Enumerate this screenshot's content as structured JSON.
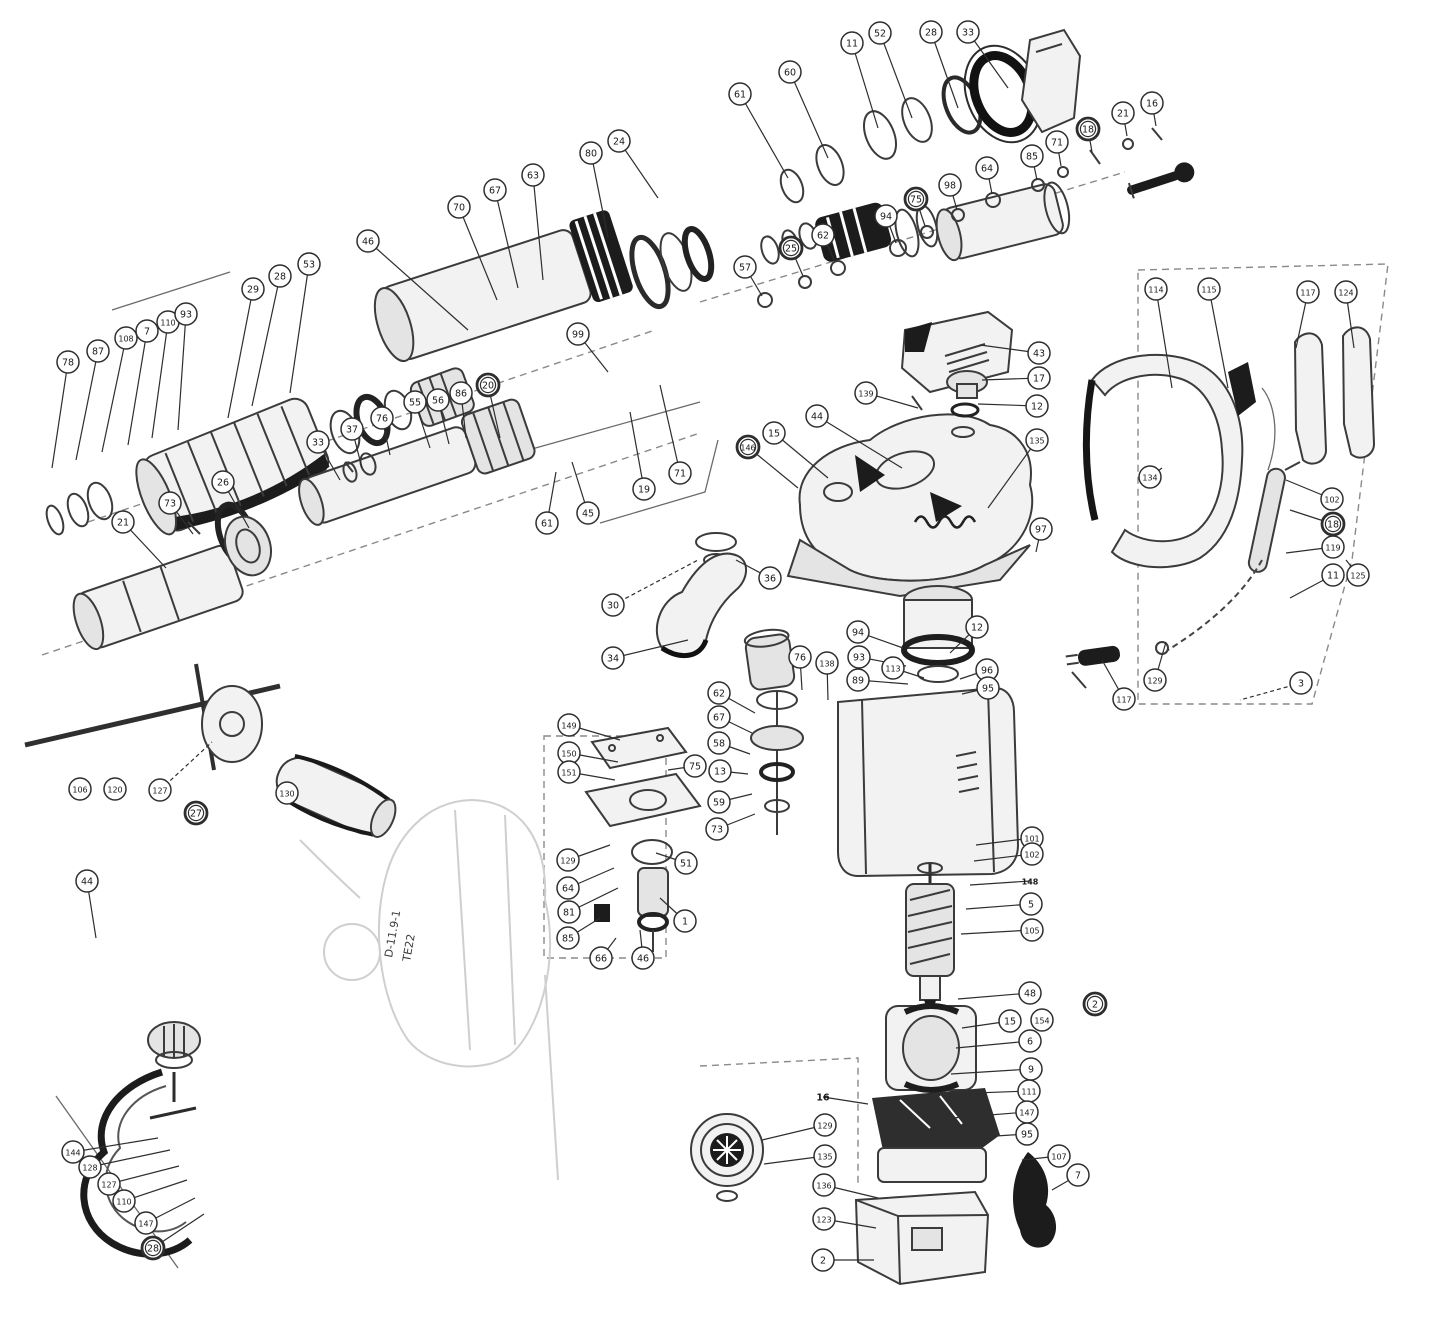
{
  "diagram": {
    "kind": "exploded-parts-diagram",
    "subject": "rotary-hammer-drill",
    "stamp": {
      "line1": "D-11.9-1",
      "line2": "TE22"
    },
    "style": {
      "ink": "#2e2e2e",
      "paper": "#ffffff",
      "callout_fill": "#ffffff"
    },
    "callouts": [
      {
        "n": "78",
        "x": 68,
        "y": 362,
        "tx": 52,
        "ty": 468
      },
      {
        "n": "87",
        "x": 98,
        "y": 351,
        "tx": 76,
        "ty": 460
      },
      {
        "n": "108",
        "x": 126,
        "y": 338,
        "tx": 102,
        "ty": 452
      },
      {
        "n": "7",
        "x": 147,
        "y": 331,
        "tx": 128,
        "ty": 445
      },
      {
        "n": "110",
        "x": 168,
        "y": 322,
        "tx": 152,
        "ty": 438
      },
      {
        "n": "93",
        "x": 186,
        "y": 314,
        "tx": 178,
        "ty": 430
      },
      {
        "n": "29",
        "x": 253,
        "y": 289,
        "tx": 228,
        "ty": 418
      },
      {
        "n": "28",
        "x": 280,
        "y": 276,
        "tx": 252,
        "ty": 406
      },
      {
        "n": "53",
        "x": 309,
        "y": 264,
        "tx": 290,
        "ty": 393
      },
      {
        "n": "46",
        "x": 368,
        "y": 241,
        "tx": 468,
        "ty": 330
      },
      {
        "n": "70",
        "x": 459,
        "y": 207,
        "tx": 497,
        "ty": 300
      },
      {
        "n": "67",
        "x": 495,
        "y": 190,
        "tx": 518,
        "ty": 288
      },
      {
        "n": "63",
        "x": 533,
        "y": 175,
        "tx": 543,
        "ty": 280
      },
      {
        "n": "80",
        "x": 591,
        "y": 153,
        "tx": 608,
        "ty": 238
      },
      {
        "n": "24",
        "x": 619,
        "y": 141,
        "tx": 658,
        "ty": 198
      },
      {
        "n": "61",
        "x": 740,
        "y": 94,
        "tx": 788,
        "ty": 178
      },
      {
        "n": "60",
        "x": 790,
        "y": 72,
        "tx": 828,
        "ty": 158
      },
      {
        "n": "11",
        "x": 852,
        "y": 43,
        "tx": 878,
        "ty": 128
      },
      {
        "n": "52",
        "x": 880,
        "y": 33,
        "tx": 912,
        "ty": 118
      },
      {
        "n": "28",
        "x": 931,
        "y": 32,
        "tx": 958,
        "ty": 108
      },
      {
        "n": "33",
        "x": 968,
        "y": 32,
        "tx": 1008,
        "ty": 88
      },
      {
        "n": "57",
        "x": 745,
        "y": 267,
        "tx": 762,
        "ty": 296
      },
      {
        "n": "25",
        "x": 791,
        "y": 248,
        "b": 1,
        "tx": 803,
        "ty": 276
      },
      {
        "n": "62",
        "x": 823,
        "y": 235,
        "tx": 835,
        "ty": 262
      },
      {
        "n": "94",
        "x": 886,
        "y": 216,
        "tx": 896,
        "ty": 243
      },
      {
        "n": "75",
        "x": 916,
        "y": 199,
        "b": 1,
        "tx": 925,
        "ty": 226
      },
      {
        "n": "98",
        "x": 950,
        "y": 185,
        "tx": 957,
        "ty": 210
      },
      {
        "n": "64",
        "x": 987,
        "y": 168,
        "tx": 992,
        "ty": 194
      },
      {
        "n": "85",
        "x": 1032,
        "y": 156,
        "tx": 1037,
        "ty": 180
      },
      {
        "n": "71",
        "x": 1057,
        "y": 142,
        "tx": 1061,
        "ty": 166
      },
      {
        "n": "18",
        "x": 1088,
        "y": 129,
        "b": 1,
        "tx": 1092,
        "ty": 152
      },
      {
        "n": "21",
        "x": 1123,
        "y": 113,
        "tx": 1127,
        "ty": 136
      },
      {
        "n": "16",
        "x": 1152,
        "y": 103,
        "tx": 1156,
        "ty": 126
      },
      {
        "n": "43",
        "x": 1039,
        "y": 353,
        "tx": 980,
        "ty": 345
      },
      {
        "n": "17",
        "x": 1039,
        "y": 378,
        "tx": 982,
        "ty": 380
      },
      {
        "n": "12",
        "x": 1037,
        "y": 406,
        "tx": 978,
        "ty": 404
      },
      {
        "n": "139",
        "x": 866,
        "y": 393,
        "tx": 918,
        "ty": 408
      },
      {
        "n": "44",
        "x": 817,
        "y": 416,
        "tx": 902,
        "ty": 468
      },
      {
        "n": "15",
        "x": 774,
        "y": 433,
        "tx": 828,
        "ty": 478
      },
      {
        "n": "146",
        "x": 748,
        "y": 447,
        "b": 1,
        "tx": 798,
        "ty": 488
      },
      {
        "n": "135",
        "x": 1037,
        "y": 440,
        "tx": 988,
        "ty": 508
      },
      {
        "n": "97",
        "x": 1041,
        "y": 529,
        "tx": 1036,
        "ty": 552
      },
      {
        "n": "114",
        "x": 1156,
        "y": 289,
        "tx": 1172,
        "ty": 388
      },
      {
        "n": "115",
        "x": 1209,
        "y": 289,
        "tx": 1228,
        "ty": 388
      },
      {
        "n": "117",
        "x": 1308,
        "y": 292,
        "tx": 1296,
        "ty": 348
      },
      {
        "n": "124",
        "x": 1346,
        "y": 292,
        "tx": 1354,
        "ty": 348
      },
      {
        "n": "134",
        "x": 1150,
        "y": 477,
        "tx": 1162,
        "ty": 468
      },
      {
        "n": "102",
        "x": 1332,
        "y": 499,
        "tx": 1286,
        "ty": 480
      },
      {
        "n": "18",
        "x": 1333,
        "y": 524,
        "b": 1,
        "tx": 1290,
        "ty": 510
      },
      {
        "n": "119",
        "x": 1333,
        "y": 547,
        "tx": 1286,
        "ty": 553
      },
      {
        "n": "11",
        "x": 1333,
        "y": 575,
        "tx": 1290,
        "ty": 598
      },
      {
        "n": "125",
        "x": 1358,
        "y": 575,
        "tx": 1346,
        "ty": 560
      },
      {
        "n": "117",
        "x": 1124,
        "y": 699,
        "tx": 1102,
        "ty": 660
      },
      {
        "n": "129",
        "x": 1155,
        "y": 680,
        "tx": 1166,
        "ty": 642
      },
      {
        "n": "3",
        "x": 1301,
        "y": 683,
        "d": 1,
        "tx": 1240,
        "ty": 700
      },
      {
        "n": "99",
        "x": 578,
        "y": 334,
        "tx": 608,
        "ty": 372
      },
      {
        "n": "19",
        "x": 644,
        "y": 489,
        "tx": 630,
        "ty": 412
      },
      {
        "n": "71",
        "x": 680,
        "y": 473,
        "tx": 660,
        "ty": 385
      },
      {
        "n": "45",
        "x": 588,
        "y": 513,
        "tx": 572,
        "ty": 462
      },
      {
        "n": "61",
        "x": 547,
        "y": 523,
        "tx": 556,
        "ty": 472
      },
      {
        "n": "30",
        "x": 613,
        "y": 605,
        "d": 1,
        "tx": 698,
        "ty": 560
      },
      {
        "n": "34",
        "x": 613,
        "y": 658,
        "tx": 688,
        "ty": 640
      },
      {
        "n": "36",
        "x": 770,
        "y": 578,
        "tx": 736,
        "ty": 560
      },
      {
        "n": "33",
        "x": 318,
        "y": 442,
        "tx": 340,
        "ty": 480
      },
      {
        "n": "37",
        "x": 352,
        "y": 429,
        "tx": 362,
        "ty": 468
      },
      {
        "n": "76",
        "x": 382,
        "y": 418,
        "tx": 390,
        "ty": 455
      },
      {
        "n": "55",
        "x": 415,
        "y": 402,
        "tx": 430,
        "ty": 448
      },
      {
        "n": "56",
        "x": 438,
        "y": 400,
        "tx": 449,
        "ty": 444
      },
      {
        "n": "86",
        "x": 461,
        "y": 393,
        "tx": 466,
        "ty": 438
      },
      {
        "n": "20",
        "x": 488,
        "y": 385,
        "b": 1,
        "tx": 500,
        "ty": 438
      },
      {
        "n": "21",
        "x": 123,
        "y": 522,
        "tx": 166,
        "ty": 568
      },
      {
        "n": "73",
        "x": 170,
        "y": 503,
        "tx": 193,
        "ty": 534
      },
      {
        "n": "26",
        "x": 223,
        "y": 482,
        "tx": 249,
        "ty": 528
      },
      {
        "n": "106",
        "x": 80,
        "y": 789
      },
      {
        "n": "120",
        "x": 115,
        "y": 789
      },
      {
        "n": "127",
        "x": 160,
        "y": 790,
        "d": 1,
        "tx": 212,
        "ty": 742
      },
      {
        "n": "27",
        "x": 196,
        "y": 813,
        "b": 1
      },
      {
        "n": "130",
        "x": 287,
        "y": 793
      },
      {
        "n": "44",
        "x": 87,
        "y": 881,
        "tx": 96,
        "ty": 938
      },
      {
        "n": "149",
        "x": 569,
        "y": 725,
        "tx": 620,
        "ty": 740
      },
      {
        "n": "150",
        "x": 569,
        "y": 753,
        "tx": 618,
        "ty": 762
      },
      {
        "n": "151",
        "x": 569,
        "y": 772,
        "tx": 615,
        "ty": 780
      },
      {
        "n": "129",
        "x": 568,
        "y": 860,
        "tx": 610,
        "ty": 845
      },
      {
        "n": "64",
        "x": 568,
        "y": 888,
        "tx": 614,
        "ty": 868
      },
      {
        "n": "81",
        "x": 569,
        "y": 912,
        "tx": 618,
        "ty": 888
      },
      {
        "n": "85",
        "x": 568,
        "y": 938,
        "tx": 600,
        "ty": 918
      },
      {
        "n": "66",
        "x": 601,
        "y": 958,
        "tx": 616,
        "ty": 938
      },
      {
        "n": "46",
        "x": 643,
        "y": 958,
        "tx": 640,
        "ty": 930
      },
      {
        "n": "51",
        "x": 686,
        "y": 863,
        "tx": 656,
        "ty": 853
      },
      {
        "n": "1",
        "x": 685,
        "y": 921,
        "tx": 660,
        "ty": 898
      },
      {
        "n": "75",
        "x": 695,
        "y": 766,
        "tx": 668,
        "ty": 770
      },
      {
        "n": "62",
        "x": 719,
        "y": 693,
        "tx": 755,
        "ty": 713
      },
      {
        "n": "67",
        "x": 719,
        "y": 717,
        "tx": 752,
        "ty": 733
      },
      {
        "n": "58",
        "x": 719,
        "y": 743,
        "tx": 750,
        "ty": 754
      },
      {
        "n": "13",
        "x": 720,
        "y": 771,
        "tx": 748,
        "ty": 774
      },
      {
        "n": "59",
        "x": 719,
        "y": 802,
        "tx": 752,
        "ty": 794
      },
      {
        "n": "73",
        "x": 717,
        "y": 829,
        "tx": 755,
        "ty": 814
      },
      {
        "n": "76",
        "x": 800,
        "y": 657,
        "tx": 802,
        "ty": 690
      },
      {
        "n": "138",
        "x": 827,
        "y": 663,
        "tx": 828,
        "ty": 700
      },
      {
        "n": "94",
        "x": 858,
        "y": 632,
        "tx": 903,
        "ty": 648
      },
      {
        "n": "93",
        "x": 859,
        "y": 657,
        "tx": 906,
        "ty": 666
      },
      {
        "n": "89",
        "x": 858,
        "y": 680,
        "tx": 908,
        "ty": 684
      },
      {
        "n": "113",
        "x": 893,
        "y": 668,
        "tx": 924,
        "ty": 678
      },
      {
        "n": "12",
        "x": 977,
        "y": 627,
        "tx": 950,
        "ty": 653
      },
      {
        "n": "96",
        "x": 987,
        "y": 670,
        "tx": 960,
        "ty": 679
      },
      {
        "n": "95",
        "x": 988,
        "y": 688,
        "tx": 962,
        "ty": 694
      },
      {
        "n": "101",
        "x": 1032,
        "y": 838,
        "tx": 976,
        "ty": 845
      },
      {
        "n": "102",
        "x": 1032,
        "y": 854,
        "tx": 974,
        "ty": 861
      },
      {
        "n": "148",
        "x": 1030,
        "y": 881,
        "t": 1,
        "tx": 970,
        "ty": 885
      },
      {
        "n": "5",
        "x": 1031,
        "y": 904,
        "tx": 966,
        "ty": 909
      },
      {
        "n": "105",
        "x": 1032,
        "y": 930,
        "tx": 961,
        "ty": 934
      },
      {
        "n": "48",
        "x": 1030,
        "y": 993,
        "tx": 958,
        "ty": 999
      },
      {
        "n": "15",
        "x": 1010,
        "y": 1021,
        "tx": 962,
        "ty": 1028
      },
      {
        "n": "154",
        "x": 1042,
        "y": 1020
      },
      {
        "n": "6",
        "x": 1030,
        "y": 1041,
        "tx": 956,
        "ty": 1048
      },
      {
        "n": "9",
        "x": 1031,
        "y": 1069,
        "tx": 951,
        "ty": 1074
      },
      {
        "n": "111",
        "x": 1029,
        "y": 1091,
        "tx": 948,
        "ty": 1094
      },
      {
        "n": "2",
        "x": 1095,
        "y": 1004,
        "b": 1
      },
      {
        "n": "147",
        "x": 1027,
        "y": 1112,
        "tx": 952,
        "ty": 1118
      },
      {
        "n": "95",
        "x": 1027,
        "y": 1134,
        "tx": 950,
        "ty": 1139
      },
      {
        "n": "107",
        "x": 1059,
        "y": 1156,
        "tx": 1022,
        "ty": 1160
      },
      {
        "n": "7",
        "x": 1078,
        "y": 1175,
        "tx": 1052,
        "ty": 1190
      },
      {
        "n": "16",
        "x": 823,
        "y": 1097,
        "t": 1,
        "tx": 868,
        "ty": 1104
      },
      {
        "n": "129",
        "x": 825,
        "y": 1125,
        "tx": 762,
        "ty": 1140
      },
      {
        "n": "135",
        "x": 825,
        "y": 1156,
        "tx": 764,
        "ty": 1164
      },
      {
        "n": "136",
        "x": 824,
        "y": 1185,
        "tx": 878,
        "ty": 1198
      },
      {
        "n": "123",
        "x": 824,
        "y": 1219,
        "tx": 876,
        "ty": 1228
      },
      {
        "n": "2",
        "x": 823,
        "y": 1260,
        "tx": 874,
        "ty": 1260
      },
      {
        "n": "144",
        "x": 73,
        "y": 1152,
        "tx": 158,
        "ty": 1138
      },
      {
        "n": "128",
        "x": 90,
        "y": 1167,
        "tx": 170,
        "ty": 1150
      },
      {
        "n": "127",
        "x": 109,
        "y": 1184,
        "tx": 179,
        "ty": 1166
      },
      {
        "n": "110",
        "x": 124,
        "y": 1201,
        "tx": 187,
        "ty": 1180
      },
      {
        "n": "147",
        "x": 146,
        "y": 1223,
        "tx": 195,
        "ty": 1198
      },
      {
        "n": "28",
        "x": 153,
        "y": 1248,
        "b": 1,
        "tx": 204,
        "ty": 1214
      }
    ]
  }
}
